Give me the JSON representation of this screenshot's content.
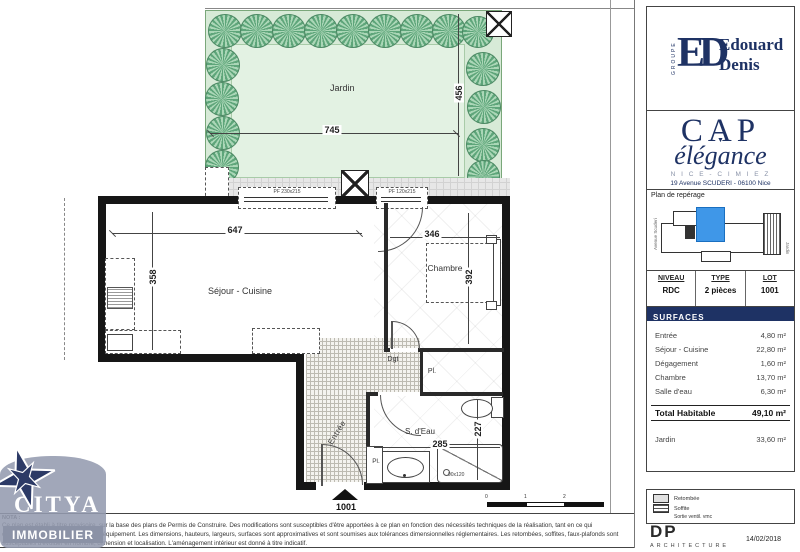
{
  "branding": {
    "groupe_vertical": "GROUPE",
    "monogram": "ED",
    "developer_line1": "Edouard",
    "developer_line2": "Denis",
    "program_name_1": "CAP",
    "program_name_2": "élégance",
    "program_marker": "▼",
    "program_location": "N I C E - C I M I E Z",
    "program_address": "19 Avenue SCUDERI - 06100 Nice"
  },
  "reperage": {
    "title": "Plan de repérage",
    "left_label": "Avenue Scuderi",
    "right_label": "Jardin"
  },
  "lot_table": {
    "headers": [
      "NIVEAU",
      "TYPE",
      "LOT"
    ],
    "values": [
      "RDC",
      "2 pièces",
      "1001"
    ]
  },
  "surfaces": {
    "title": "SURFACES",
    "rows": [
      {
        "label": "Entrée",
        "value": "4,80 m²"
      },
      {
        "label": "Séjour - Cuisine",
        "value": "22,80 m²"
      },
      {
        "label": "Dégagement",
        "value": "1,60 m²"
      },
      {
        "label": "Chambre",
        "value": "13,70 m²"
      },
      {
        "label": "Salle d'eau",
        "value": "6,30 m²"
      }
    ],
    "total_label": "Total Habitable",
    "total_value": "49,10 m²",
    "jardin_label": "Jardin",
    "jardin_value": "33,60 m²"
  },
  "plan": {
    "rooms": {
      "jardin": "Jardin",
      "sejour": "Séjour - Cuisine",
      "chambre": "Chambre",
      "sdeau": "S. d'Eau",
      "entree": "Entrée",
      "dgt": "Dgt",
      "pl1": "Pl.",
      "pl2": "Pl."
    },
    "dims": {
      "jardin_w": "745",
      "jardin_h": "456",
      "sejour_w": "647",
      "sejour_h": "358",
      "chambre_w": "346",
      "chambre_h": "392",
      "sdeau_w": "285",
      "sdeau_h": "227"
    },
    "windows": {
      "w1": "PF 230x215",
      "w2": "PF 120x215"
    },
    "shower_label": "90x120",
    "lot_marker": "1001",
    "scale_ticks": [
      "0",
      "1",
      "2"
    ]
  },
  "legend": {
    "items": [
      {
        "label": "Retombée"
      },
      {
        "label": "Soffite"
      },
      {
        "label": "Sortie ventil. vmc"
      }
    ]
  },
  "architect": {
    "name": "DP",
    "subtitle": "ARCHITECTURE",
    "date": "14/02/2018"
  },
  "agency": {
    "name": "CITYA",
    "subtitle": "IMMOBILIER"
  },
  "nota": {
    "heading": "NOTA :",
    "lines": [
      "Ce plan est établi à titre provisoire, sur la base des plans de Permis de Construire. Des modifications sont susceptibles d'être apportées à ce plan en fonction des nécessités techniques de la réalisation, tant en ce qui",
      "concerne les dimensions finies que l'équipement. Les dimensions, hauteurs, largeurs, surfaces sont approximatives et sont soumises aux tolérances dimensionnelles réglementaires. Les retombées, soffites, faux-plafonds sont",
      "susceptibles d'évoluer en nombre, dimension et localisation. L'aménagement intérieur est donné à titre indicatif."
    ]
  },
  "colors": {
    "navy": "#1e3264",
    "garden_fill": "#d7ead7",
    "lawn_fill": "#e3f2e3",
    "tree_green": "#58a276",
    "map_highlight": "#3f97e8",
    "citya_gray": "#99a0b3"
  }
}
